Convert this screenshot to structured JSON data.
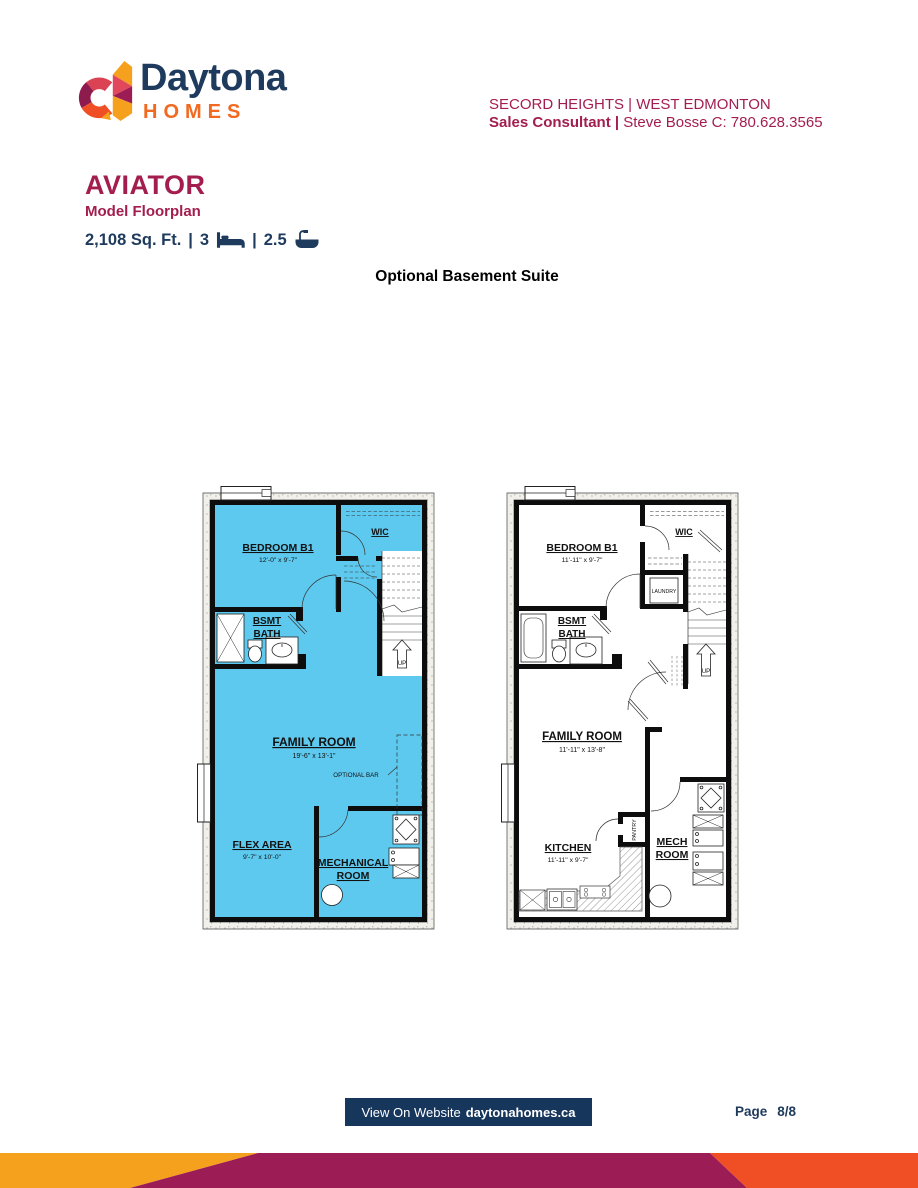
{
  "header": {
    "brand": "Daytona",
    "brand_sub": "HOMES",
    "community": "SECORD HEIGHTS | WEST EDMONTON",
    "consultant_label": "Sales Consultant |",
    "consultant_info": " Steve Bosse C: 780.628.3565"
  },
  "model": {
    "name": "AVIATOR",
    "subtitle": "Model Floorplan",
    "sqft": "2,108 Sq. Ft.",
    "separator": "|",
    "beds": "3",
    "baths": "2.5"
  },
  "section_title": "Optional Basement Suite",
  "plans": {
    "left": {
      "bedroom_name": "BEDROOM B1",
      "bedroom_dim": "12'-0\" x 9'-7\"",
      "wic": "WIC",
      "bath_line1": "BSMT",
      "bath_line2": "BATH",
      "family_name": "FAMILY ROOM",
      "family_dim": "19'-6\" x 13'-1\"",
      "optional_bar": "OPTIONAL BAR",
      "flex_name": "FLEX AREA",
      "flex_dim": "9'-7\" x 10'-0\"",
      "mech_line1": "MECHANICAL",
      "mech_line2": "ROOM",
      "up": "UP"
    },
    "right": {
      "bedroom_name": "BEDROOM B1",
      "bedroom_dim": "11'-11\" x 9'-7\"",
      "wic": "WIC",
      "laundry": "LAUNDRY",
      "bath_line1": "BSMT",
      "bath_line2": "BATH",
      "family_name": "FAMILY ROOM",
      "family_dim": "11'-11\" x 13'-8\"",
      "kitchen_name": "KITCHEN",
      "kitchen_dim": "11'-11\" x 9'-7\"",
      "pantry": "PANTRY",
      "mech_line1": "MECH",
      "mech_line2": "ROOM",
      "up": "UP"
    }
  },
  "footer": {
    "website_label": "View On Website",
    "website_domain": "daytonahomes.ca",
    "page_label": "Page",
    "page_value": "8/8"
  },
  "colors": {
    "brand_navy": "#1E3A5C",
    "brand_orange": "#F26A21",
    "maroon": "#A31D4F",
    "suite_cyan": "#5EC9EE",
    "button_navy": "#16365C",
    "stripe_amber": "#F6A11E",
    "stripe_maroon": "#9C1C56",
    "stripe_red": "#F04E24"
  }
}
